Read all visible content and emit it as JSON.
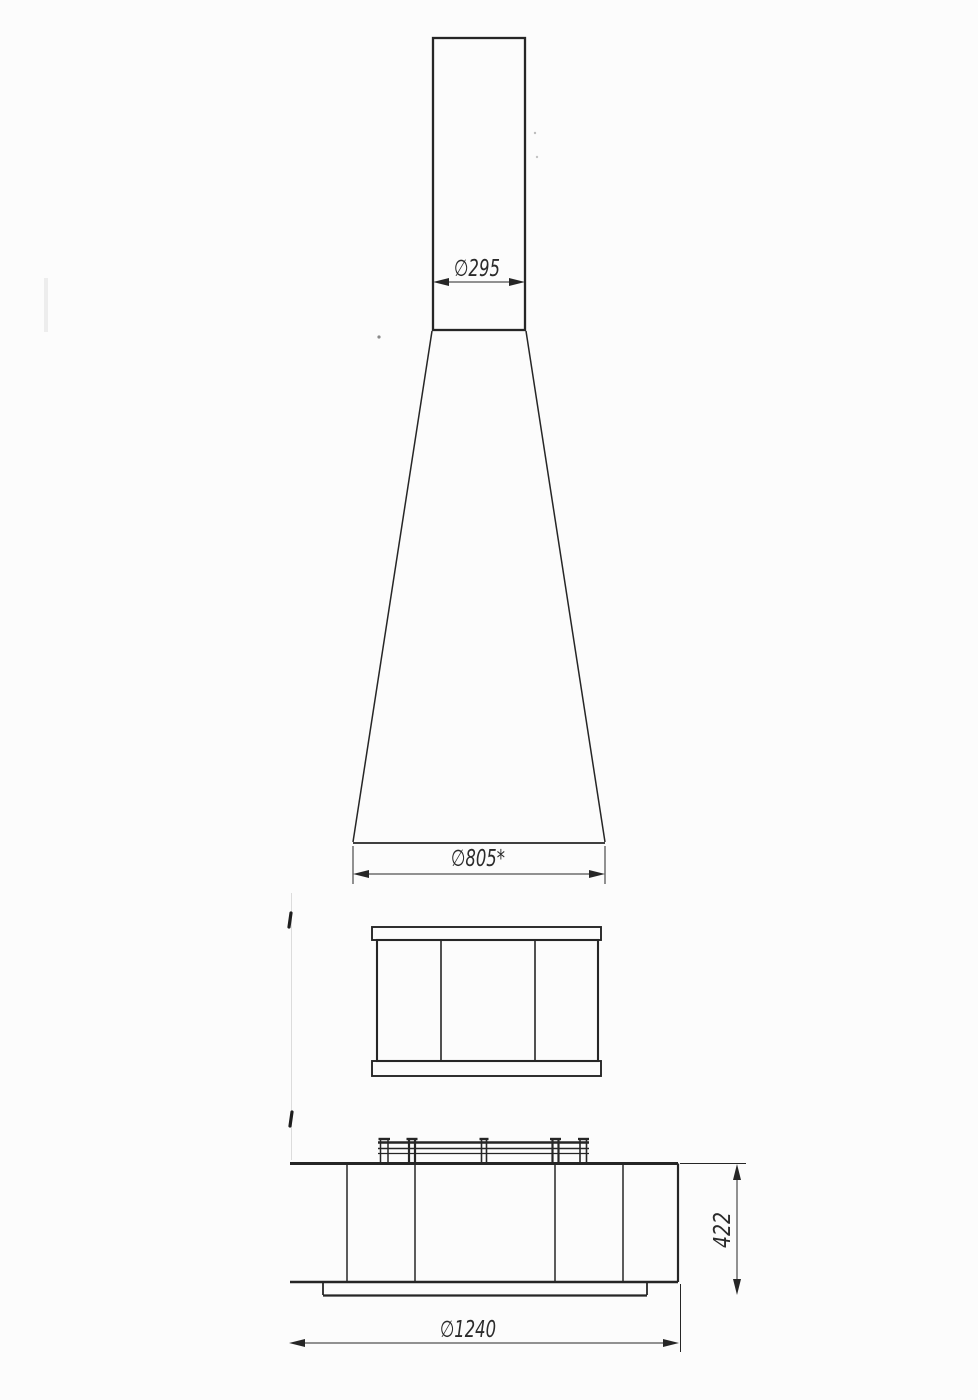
{
  "drawing": {
    "background": "#fcfcfc",
    "line_color": "#262626",
    "dimensions": {
      "pipe_diameter": "∅295",
      "hood_diameter": "∅805*",
      "base_height": "422",
      "base_diameter": "∅1240"
    }
  }
}
